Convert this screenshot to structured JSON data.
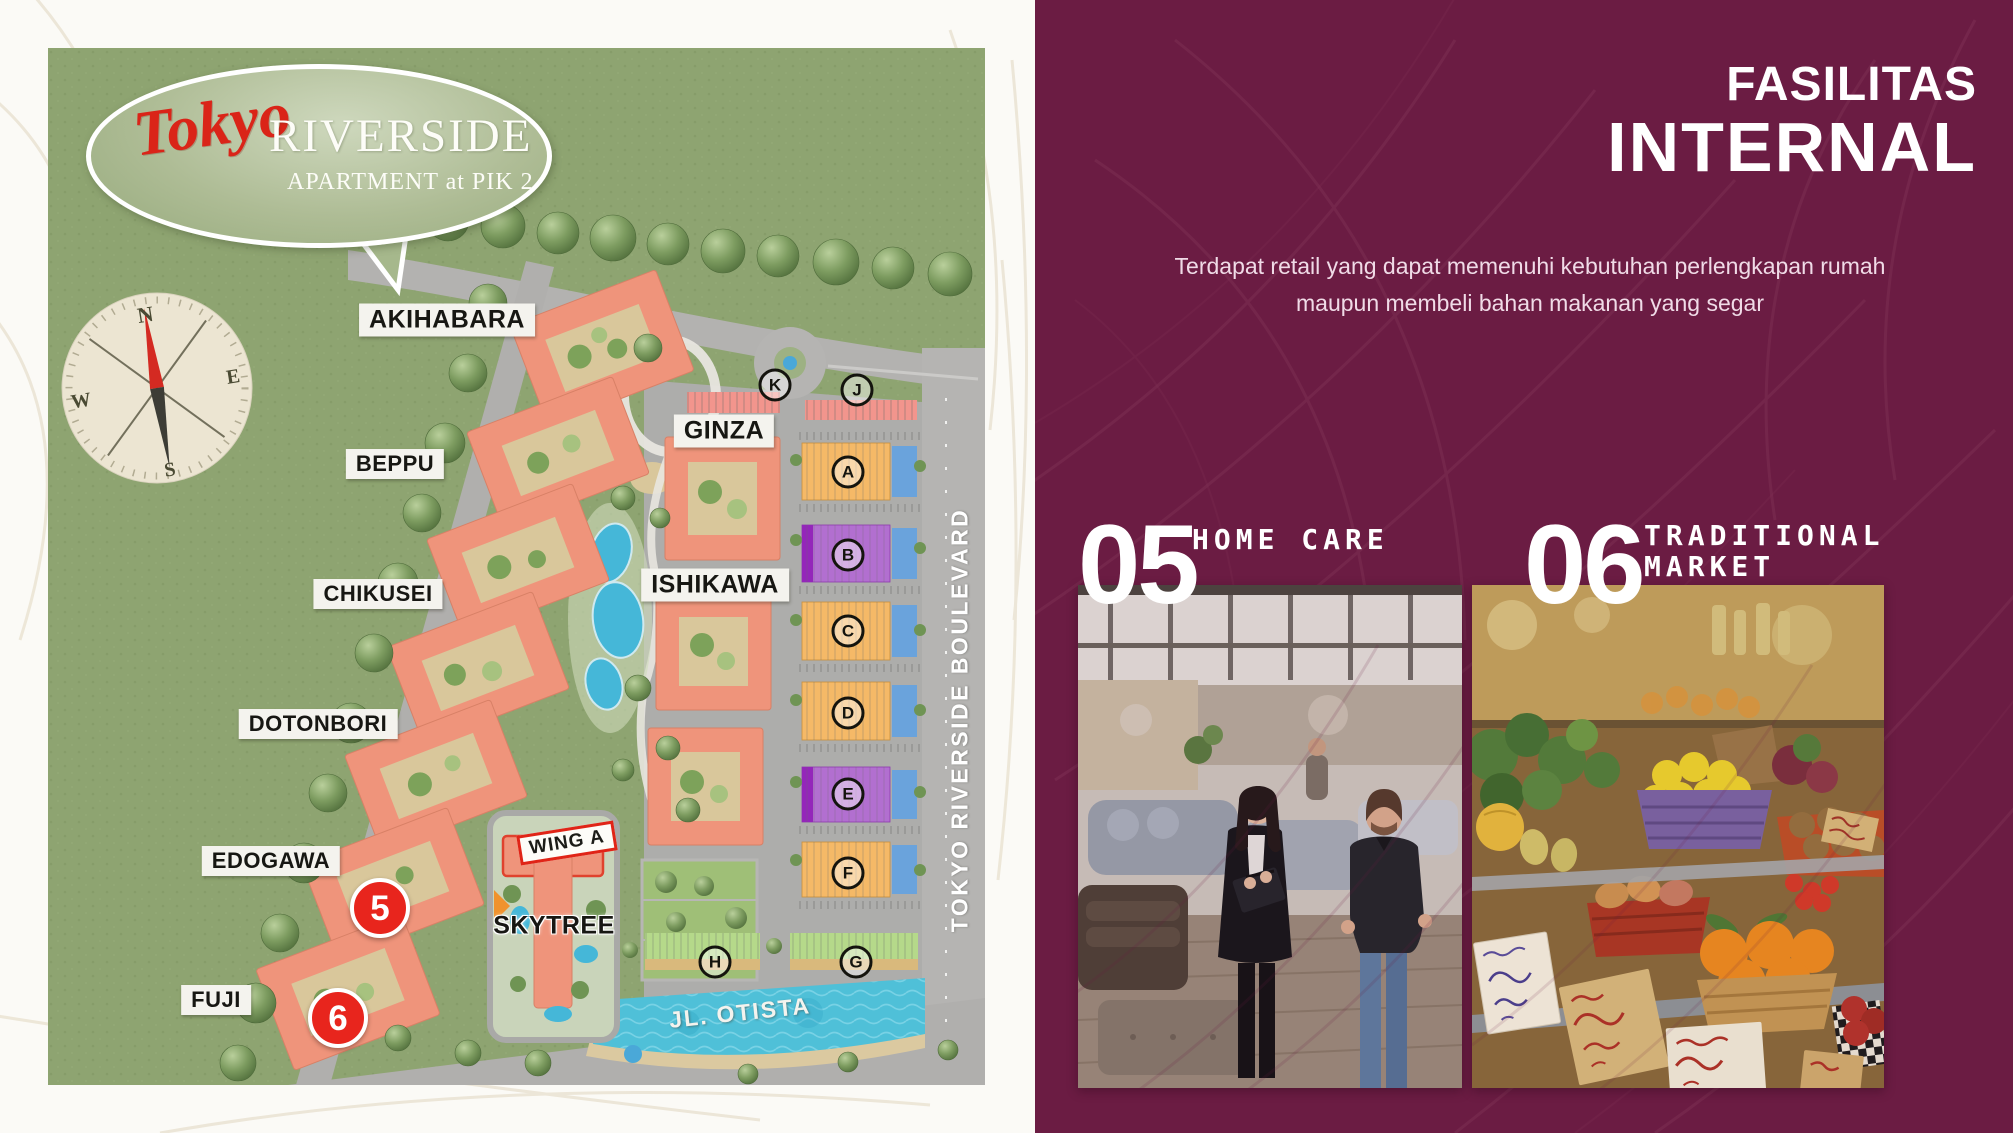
{
  "page": {
    "width": 2013,
    "height": 1133
  },
  "colors": {
    "panel_maroon": "#6B1C43",
    "panel_pattern_line": "#7D2F53",
    "map_green": "#8EA471",
    "road_gray": "#ACACAA",
    "building_salmon": "#EF947B",
    "accent_red": "#E8251D",
    "block_orange": "#F5B967",
    "block_purple": "#B26FD0",
    "block_blue": "#6AA3DC",
    "block_green": "#B5D98A",
    "block_pink": "#F2958D",
    "water_teal": "#4FC0D8"
  },
  "map": {
    "logo": {
      "brand_script": "Tokyo",
      "title": "RIVERSIDE",
      "subtitle": "APARTMENT at PIK 2"
    },
    "compass": {
      "north": "N",
      "east": "E",
      "south": "S",
      "west": "W"
    },
    "area_labels": [
      {
        "id": "akihabara",
        "text": "AKIHABARA"
      },
      {
        "id": "ginza",
        "text": "GINZA"
      },
      {
        "id": "beppu",
        "text": "BEPPU"
      },
      {
        "id": "ishikawa",
        "text": "ISHIKAWA"
      },
      {
        "id": "chikusei",
        "text": "CHIKUSEI"
      },
      {
        "id": "dotonbori",
        "text": "DOTONBORI"
      },
      {
        "id": "edogawa",
        "text": "EDOGAWA"
      },
      {
        "id": "fuji",
        "text": "FUJI"
      },
      {
        "id": "skytree",
        "text": "SKYTREE"
      }
    ],
    "wing_label": "WING A",
    "road_labels": {
      "boulevard": "TOKYO RIVERSIDE BOULEVARD",
      "street": "JL. OTISTA"
    },
    "block_letters": [
      {
        "letter": "K"
      },
      {
        "letter": "J"
      },
      {
        "letter": "A"
      },
      {
        "letter": "B"
      },
      {
        "letter": "C"
      },
      {
        "letter": "D"
      },
      {
        "letter": "E"
      },
      {
        "letter": "F"
      },
      {
        "letter": "G"
      },
      {
        "letter": "H"
      }
    ],
    "markers": [
      {
        "number": "5"
      },
      {
        "number": "6"
      }
    ]
  },
  "panel": {
    "heading_top": "FASILITAS",
    "heading_main": "INTERNAL",
    "description_line1": "Terdapat retail yang dapat memenuhi kebutuhan perlengkapan rumah",
    "description_line2": "maupun membeli bahan makanan yang segar",
    "cards": [
      {
        "number": "05",
        "title_line1": "HOME CARE",
        "title_line2": "",
        "photo_subject": "furniture showroom with two shoppers"
      },
      {
        "number": "06",
        "title_line1": "TRADITIONAL",
        "title_line2": "MARKET",
        "photo_subject": "fresh produce market stall"
      }
    ]
  }
}
